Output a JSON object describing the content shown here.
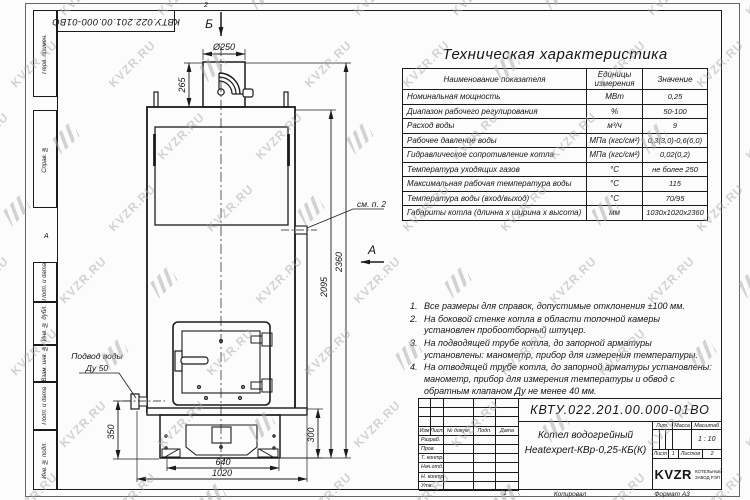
{
  "sheet": {
    "doc_number_topleft": "КВТУ.022.201.00.000-01ВО",
    "zone_top": "2",
    "zone_bottom": "1",
    "zone_left": "А",
    "copied_label": "Копировал",
    "format_label": "Формат А3"
  },
  "watermark": {
    "text": "KVZR.RU"
  },
  "frame_labels": [
    "Перв. примен.",
    "Справ. №",
    "Подп. и дата",
    "Инв. № дубл.",
    "Взам. инв. №",
    "Подп. и дата",
    "Инв. № подл."
  ],
  "spec_table": {
    "title": "Техническая характеристика",
    "headers": [
      "Наименование показателя",
      "Единицы\nизмерения",
      "Значение"
    ],
    "rows": [
      [
        "Номинальная мощность",
        "МВт",
        "0,25"
      ],
      [
        "Диапазон рабочего регулирования",
        "%",
        "50-100"
      ],
      [
        "Расход воды",
        "м³/ч",
        "9"
      ],
      [
        "Рабочее давление воды",
        "МПа (кгс/см²)",
        "0,3(3,0)-0,6(6,0)"
      ],
      [
        "Гидравлическое сопротивление котла",
        "МПа (кгс/см²)",
        "0,02(0,2)"
      ],
      [
        "Температура уходящих газов",
        "°С",
        "не более 250"
      ],
      [
        "Максимальная рабочая температура воды",
        "°С",
        "115"
      ],
      [
        "Температура воды (вход/выход)",
        "°С",
        "70/95"
      ],
      [
        "Габариты котла (длинна х ширина х высота)",
        "мм",
        "1030х1020х2360"
      ]
    ]
  },
  "notes": [
    "Все размеры для справок, допустимые отклонения ±100 мм.",
    "На боковой стенке котла в области топочной камеры установлен пробоотборный штуцер.",
    "На подводящей трубе котла, до запорной арматуры установлены: манометр, прибор для измерения температуры.",
    "На отводящей трубе котла, до запорной арматуры установлены: манометр, прибор для измерения температуры и обвод с обратным клапаном Ду не менее 40 мм."
  ],
  "dimensions": {
    "chimney_dia": "Ø250",
    "chimney_h": "265",
    "body_h": "2095",
    "total_h": "2360",
    "inlet_h": "350",
    "base_h": "300",
    "base_w": "640",
    "total_w": "1020",
    "view_b": "Б",
    "view_a": "А",
    "see_note": "см. п. 2",
    "inlet_line1": "Подвод воды",
    "inlet_line2": "Ду 50"
  },
  "title_block": {
    "doc_number": "КВТУ.022.201.00.000-01ВО",
    "product_name_1": "Котел водогрейный",
    "product_name_2": "Heatexpert-КВр-0,25-КБ(К)",
    "rev_headers": [
      "Изм",
      "Лист",
      "№ докум.",
      "Подп.",
      "Дата"
    ],
    "sign_rows": [
      "Разраб.",
      "Пров.",
      "Т. контр.",
      "Нач.отд.",
      "Н. контр.",
      "Утв."
    ],
    "lit_label": "Лит.",
    "mass_label": "Масса",
    "scale_label": "Масштаб",
    "scale_value": "1 : 10",
    "sheet_label": "Лист",
    "sheet_value": "1",
    "sheets_label": "Листов",
    "sheets_value": "2",
    "logo_text": "KVZR",
    "logo_caption_1": "КОТЕЛЬНЫЙ",
    "logo_caption_2": "ЗАВОД РЭП"
  }
}
